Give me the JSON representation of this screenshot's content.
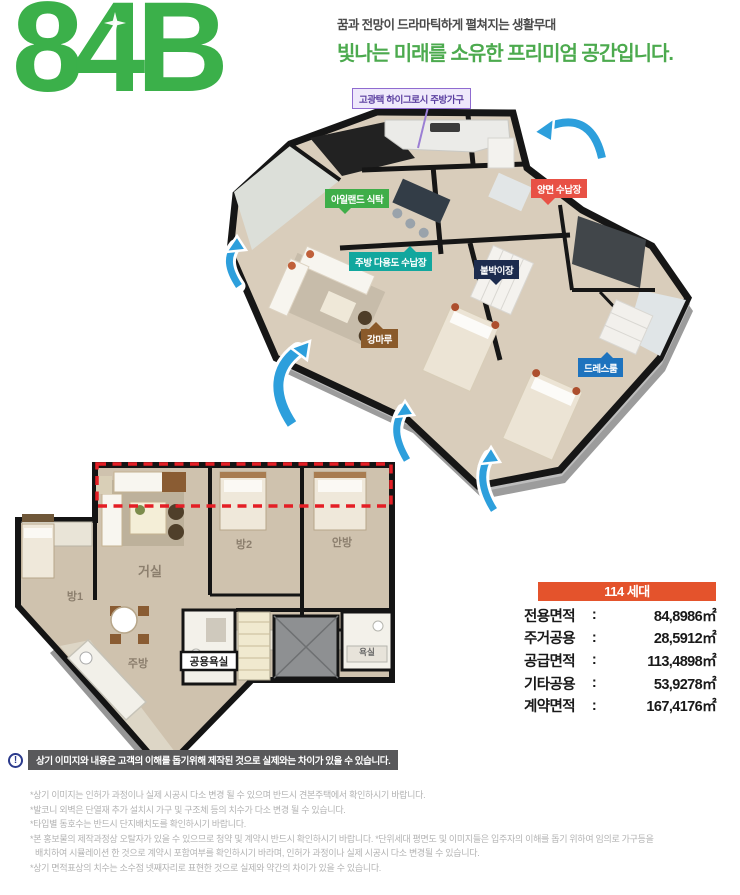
{
  "header": {
    "unit_code": "84B",
    "tagline_top": "꿈과 전망이 드라마틱하게 펼쳐지는 생활무대",
    "tagline_main": "빛나는 미래를 소유한 프리미엄 공간입니다."
  },
  "plan3d_labels": {
    "kitchen_furniture": "고광택 하이그로시 주방가구",
    "island_table": "아일랜드 식탁",
    "two_way_storage": "양면 수납장",
    "kitchen_utility_storage": "주방 다용도 수납장",
    "built_in_closet": "붙박이장",
    "hardwood_floor": "강마루",
    "dress_room": "드레스룸"
  },
  "plan2d_rooms": {
    "living": "거실",
    "room2": "방2",
    "master": "안방",
    "room1": "방1",
    "kitchen": "주방",
    "shared_bath": "공용욕실",
    "bath": "욕실"
  },
  "area_table": {
    "header": "114 세대",
    "rows": [
      {
        "label": "전용면적",
        "colon": ":",
        "value": "84,8986㎡"
      },
      {
        "label": "주거공용",
        "colon": ":",
        "value": "28,5912㎡"
      },
      {
        "label": "공급면적",
        "colon": ":",
        "value": "113,4898㎡"
      },
      {
        "label": "기타공용",
        "colon": ":",
        "value": "53,9278㎡"
      },
      {
        "label": "계약면적",
        "colon": ":",
        "value": "167,4176㎡"
      }
    ]
  },
  "notice": {
    "icon_glyph": "!",
    "text": "상기 이미지와 내용은 고객의 이해를 돕기위해 제작된 것으로 실제와는 차이가 있을 수 있습니다."
  },
  "disclaimers": [
    "*상기 이미지는 인허가 과정이나 실제 시공시 다소 변경 될 수 있으며 반드시 견본주택에서 확인하시기 바랍니다.",
    "*발코니 외벽은 단열재 추가 설치시 가구 및 구조체 등의 치수가 다소 변경 될 수 있습니다.",
    "*타입별 동호수는 반드시 단지배치도를 확인하시기 바랍니다.",
    "*본 홍보물의 제작과정상 오탈자가 있을 수 있으므로 청약 및 계약시 반드시 확인하시기 바랍니다. *단위세대 평면도 및 이미지들은 입주자의 이해를 돕기 위하여 임의로 가구등을",
    "배치하여 시뮬레이션 한 것으로 계약시 포함여부를 확인하시기 바라며, 인허가 과정이나 실제 시공시 다소 변경될 수 있습니다.",
    "*상기 면적표상의 치수는 소수점 넷째자리로 표현한 것으로 실제와 약간의 차이가 있을 수 있습니다."
  ],
  "colors": {
    "brand_green": "#3bb04a",
    "tagline_green": "#4caa4e",
    "table_header_bg": "#e4532c",
    "dashed_highlight_red": "#e41e25",
    "arrow_blue": "#2d9fdc"
  }
}
